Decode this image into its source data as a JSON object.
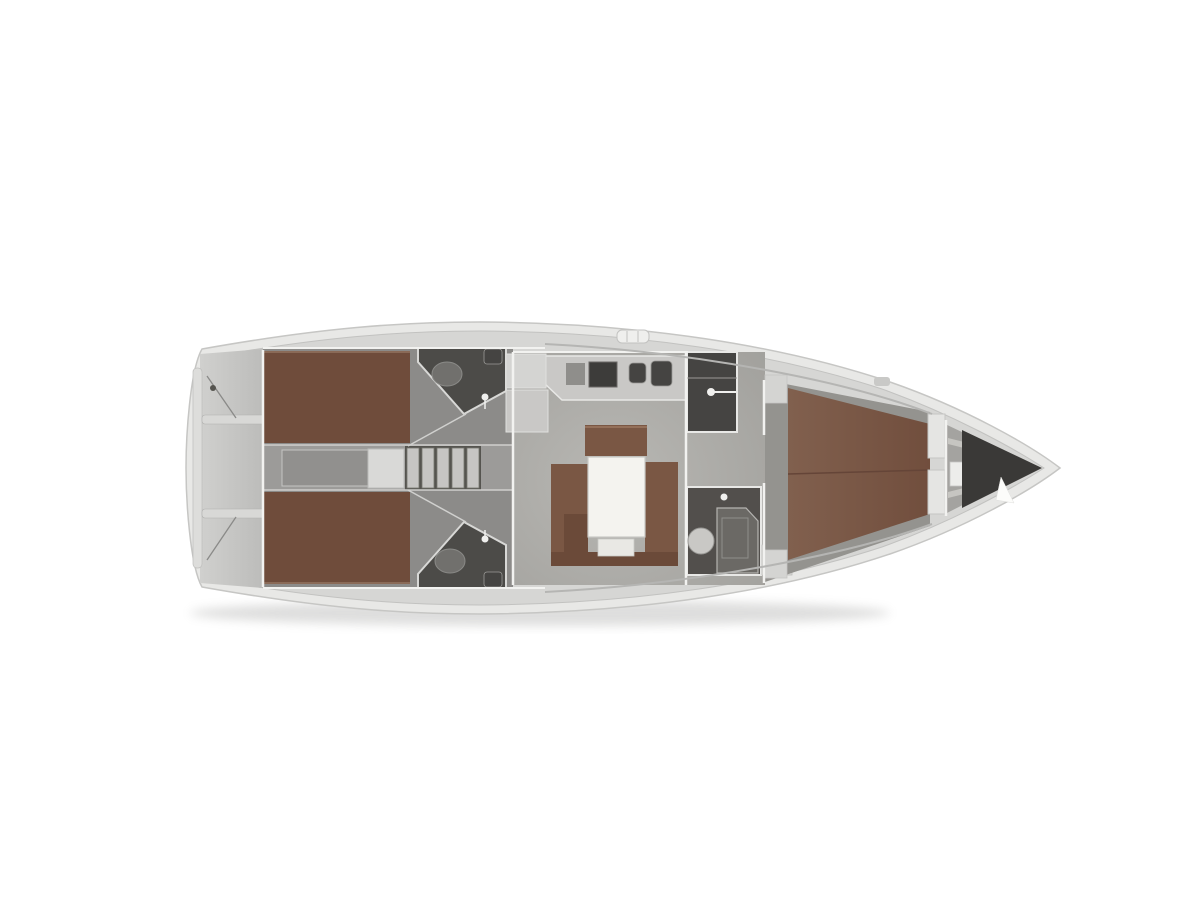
{
  "meta": {
    "description": "Top-down interior layout plan of a sailing yacht, bow pointing right, no text labels",
    "diagram_type": "boat-floor-plan"
  },
  "rooms": [
    "cockpit-with-twin-helms",
    "port-aft-double-cabin",
    "starboard-aft-double-cabin",
    "port-aft-head",
    "starboard-aft-head",
    "companionway-steps",
    "galley",
    "salon-with-table-and-settees",
    "wardrobe",
    "forward-head-with-shower",
    "forward-owner-cabin-double-berth",
    "bow-anchor-locker"
  ],
  "palette": {
    "background": "#ffffff",
    "hull": "#e8e8e6",
    "hull_outline": "#c6c6c4",
    "deck": "#d6d6d4",
    "cockpit": "#c6c5c3",
    "cockpit_fitting": "#dddddb",
    "bench": "#d8d8d6",
    "aft_floor": "#8c8b89",
    "engine_strip": "#9c9b99",
    "engine_box": "#91908e",
    "steps_dark": "#55544f",
    "step_slat": "#c6c5c3",
    "white_box": "#d9d9d7",
    "salon_floor": "#aeada9",
    "counter": "#c9c8c6",
    "cabinet": "#c9c8c6",
    "cabinet_light": "#d4d4d2",
    "appliance_dark": "#3d3c3a",
    "appliance_mid": "#8f8e8b",
    "sink_dark": "#454442",
    "berth_aft": "#6f4c3b",
    "berth_fwd": "#7b5646",
    "berth_seam": "#654538",
    "settee": "#7a5744",
    "settee_dark": "#6b4a39",
    "table_white": "#f4f3ef",
    "table_step": "#e9e8e4",
    "head_dark": "#4c4b48",
    "head_fwd": "#524f4c",
    "toilet_light": "#c9c8c5",
    "toilet_gray": "#71706d",
    "shower": "#6b6965",
    "wardrobe": "#454442",
    "locker_dark": "#3a3937",
    "bulkhead_white": "#e5e5e3",
    "wall_white": "#f2f2f0",
    "forepeak_floor": "#a4a3a0",
    "fwd_cabin_floor": "#94938f",
    "shelf_bar": "#c6c5c1",
    "line_gray": "#8a8a88",
    "coachroof_line": "#b5b5b3",
    "hatch_white": "#efefed",
    "cursor_white": "#fcfcfa"
  }
}
